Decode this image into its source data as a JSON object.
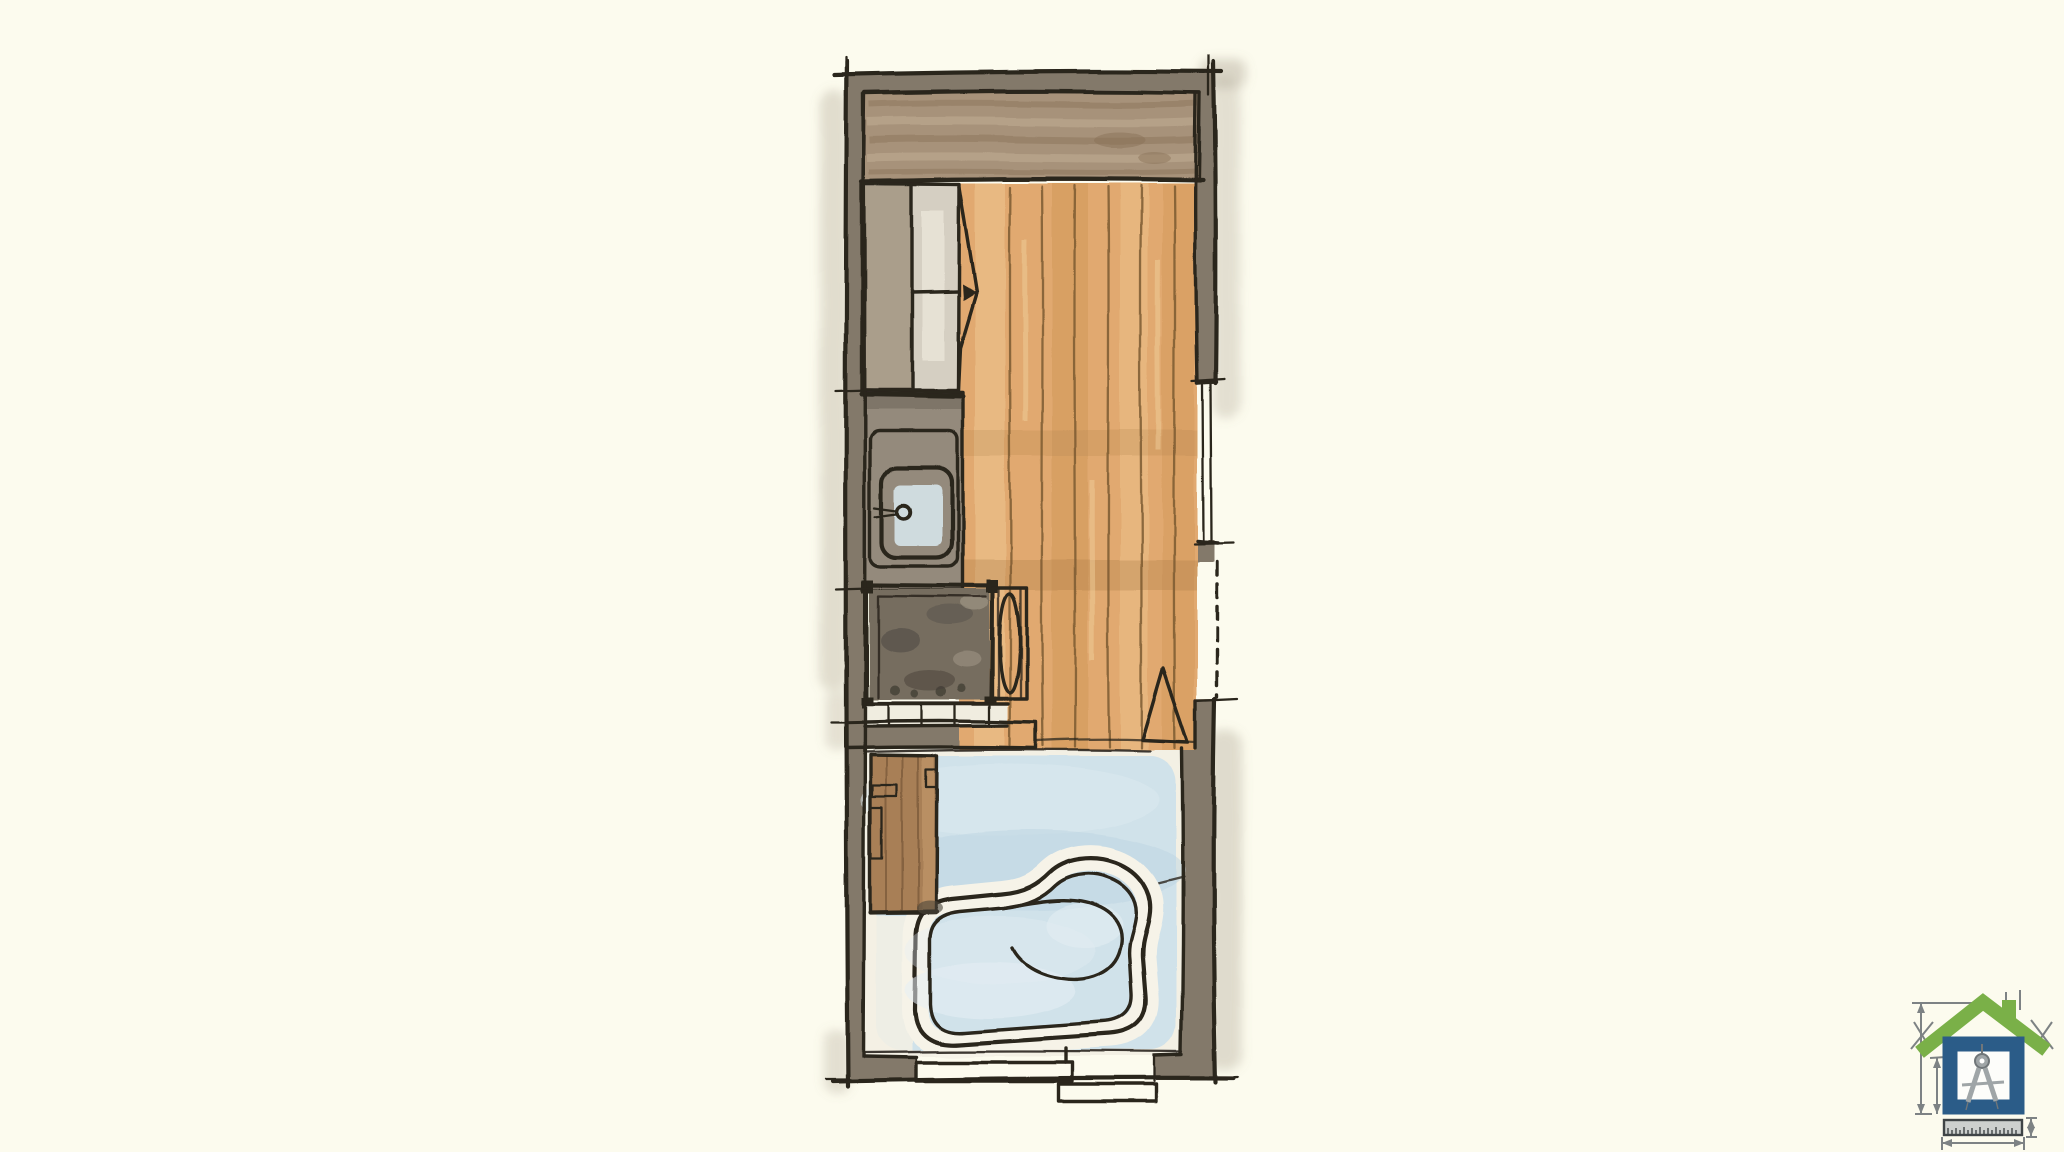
{
  "page": {
    "description": "Hand-drawn watercolor floor plan sketch of a narrow tiny-house unit with closet, sink vanity, shower, toilet, wood-plank floor, swing door and a wet room with soaking tub, plus a drafting house logo in the bottom-right corner"
  },
  "colors": {
    "background": "#fcfbee",
    "ink": "#2a251d",
    "wall_fill": "#83796a",
    "wall_wash": "#a89e8d",
    "header_wood": "#a7927a",
    "header_wood_dark": "#8a7257",
    "header_wood_light": "#c7b59a",
    "wood_floor": "#e1a96f",
    "wood_floor_light": "#f0ca96",
    "wood_floor_dark": "#c98f51",
    "wood_grain": "#7c5b31",
    "closet_shelf": "#a1947f",
    "closet_mid": "#d5cfc2",
    "counter": "#948a7b",
    "counter_dark": "#6f665a",
    "counter_inner": "#f0ede0",
    "sink_blue": "#a9c9dd",
    "sink_blue_light": "#d9e9f0",
    "shower_base": "#766d5f",
    "shower_dark": "#56514a",
    "shower_light": "#a59c8b",
    "toilet_fill": "#e6e1d3",
    "cabinet_wood": "#a87f57",
    "cabinet_grain": "#6e4f30",
    "room_pale": "#f3f0e4",
    "room_blue": "#cde0ea",
    "room_blue_deep": "#bcd4e2",
    "tub_fill": "#bed6e4",
    "tub_highlight": "#e6eff4",
    "tub_deck": "#f6f3e8"
  },
  "logo": {
    "roof_green": "#7ab048",
    "house_blue": "#2b5c88",
    "inner_white": "#fdfdfa",
    "compass_gray": "#9fa5a7",
    "compass_dark": "#707679",
    "ruler_fill": "#cdd0ce",
    "ruler_edge": "#3f4446",
    "dim": "#7d8284"
  }
}
